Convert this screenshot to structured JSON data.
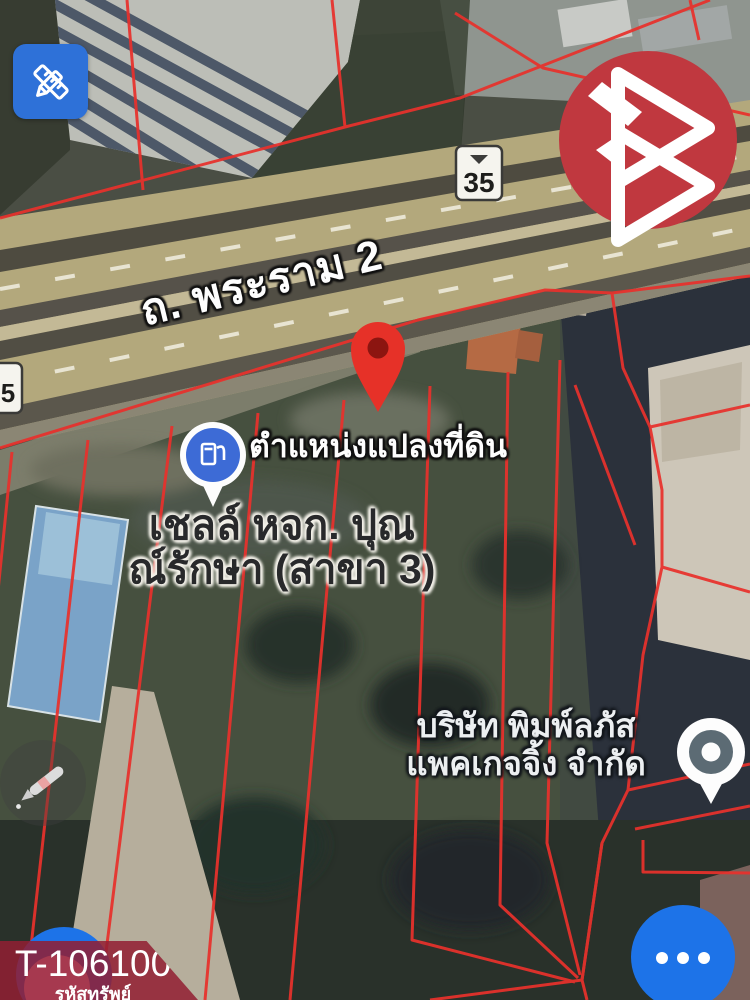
{
  "map": {
    "road_label": "ถ. พระราม 2",
    "route_shield": "35",
    "route_shield_partial_visible": "5",
    "pin_caption": "ตำแหน่งแปลงที่ดิน",
    "poi_gas_station": {
      "label_line1": "เชลล์ หจก. ปุณ",
      "label_line2": "ณ์รักษา (สาขา 3)"
    },
    "poi_company": {
      "label_line1": "บริษัท พิมพ์ลภัส",
      "label_line2": "แพคเกจจิ้ง จำกัด"
    }
  },
  "asset_banner": {
    "code": "T-106100",
    "caption": "รหัสทรัพย์"
  },
  "icons": {
    "top_left_button": "ruler-pencil-icon",
    "bottom_left_fab": "pencil-icon",
    "bottom_right_fab": "ellipsis-icon",
    "gas_marker": "fuel-pump-icon",
    "land_pin": "map-pin-icon",
    "company_marker": "place-marker-icon",
    "watermark": "triangle-b-logo"
  },
  "colors": {
    "parcel_line_red": "#e8312c",
    "tool_button_blue": "#2e71d8",
    "fab_blue": "#1d73e8",
    "brand_red": "#c0383f",
    "banner_red": "#921e32",
    "pin_red": "#e63128",
    "highway_tan": "#b3a87c"
  }
}
